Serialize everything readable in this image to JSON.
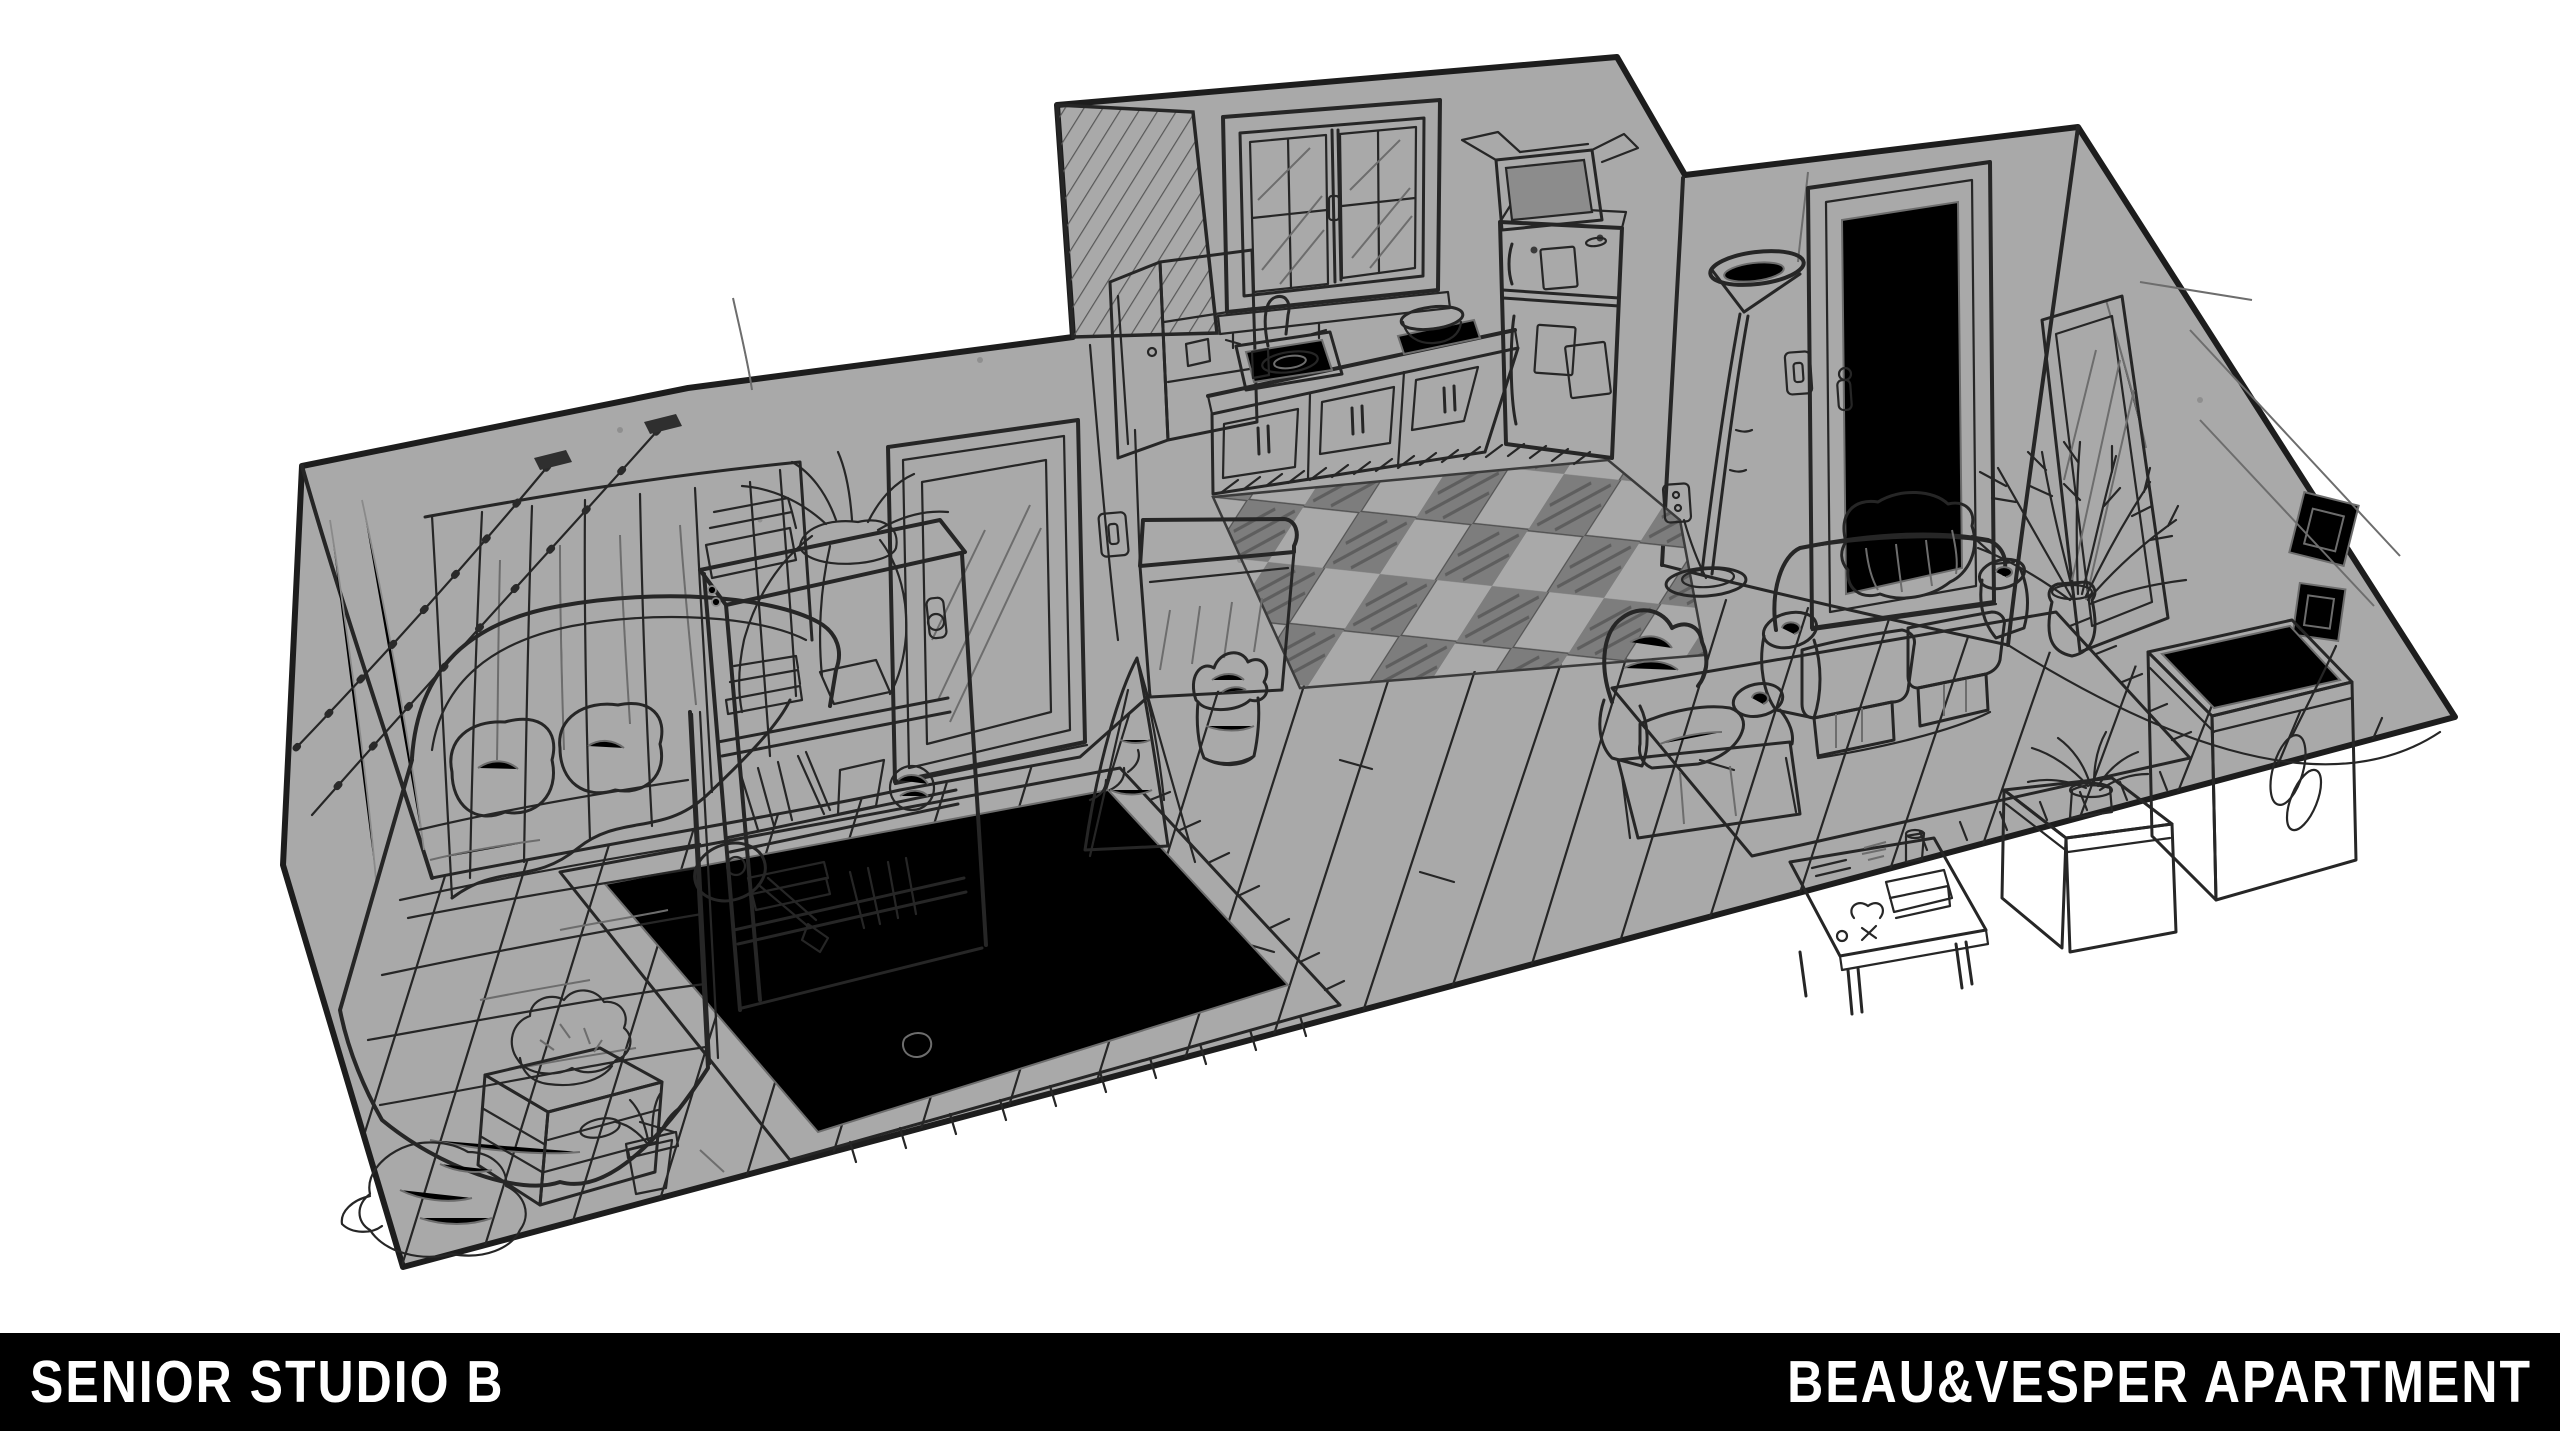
{
  "footer": {
    "left_label": "SENIOR STUDIO B",
    "right_label": "BEAU&VESPER APARTMENT",
    "bar_color": "#000000",
    "text_color": "#ffffff"
  },
  "colors": {
    "background": "#ffffff",
    "paper_gray": "#a9a9a9",
    "line": "#262626",
    "light_line": "#6d6d6d",
    "checker_dark": "#7d7d7d"
  },
  "drawing": {
    "type": "isometric cutaway pencil sketch of an apartment interior",
    "rooms": [
      {
        "name": "bedroom",
        "objects": [
          "curtained-window",
          "string-lights",
          "bed",
          "pillows",
          "blanket",
          "bookshelf",
          "plant-on-shelf",
          "door-with-mirror-panel",
          "light-switch",
          "area-rug",
          "banjo",
          "crate-nightstand",
          "plant-on-crate",
          "small-potted-plant",
          "clothes-pile",
          "sock"
        ]
      },
      {
        "name": "kitchen",
        "objects": [
          "sloped-hatched-wall",
          "open-upper-cabinet",
          "window",
          "sink",
          "faucet",
          "dish",
          "cup",
          "counter",
          "bowl",
          "lower-cabinets",
          "refrigerator",
          "cardboard-box",
          "fridge-notes",
          "checkered-tile-floor",
          "breakfast-bar",
          "trash-can",
          "drying-rack-with-cloth"
        ]
      },
      {
        "name": "living-room",
        "objects": [
          "torchiere-floor-lamp",
          "wall-outlet",
          "power-cord",
          "front-door",
          "light-switch",
          "couch",
          "throw-blanket",
          "area-rug",
          "armchair",
          "coffee-table",
          "cup",
          "books",
          "tall-potted-plant",
          "leaning-mirror",
          "picture-frames",
          "storage-chest",
          "crate-with-plant",
          "rope-coil",
          "wood-plank-floor"
        ]
      }
    ]
  }
}
